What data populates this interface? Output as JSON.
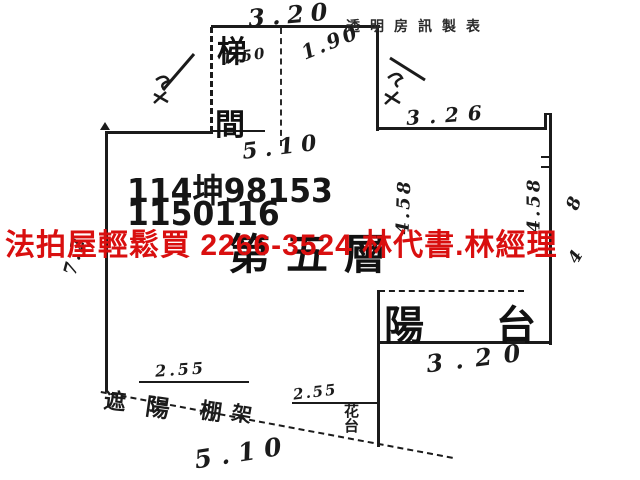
{
  "meta": {
    "publisher_label": "透明房訊製表"
  },
  "case": {
    "line1": "114坤98153",
    "line2": "1150116"
  },
  "watermark": {
    "text": "法拍屋輕鬆買 2266-3524 林代書.林經理",
    "color": "#d90f0f"
  },
  "plan": {
    "floor_label": "第五層",
    "stairwell": {
      "char_top": "梯",
      "char_bottom": "間"
    },
    "balcony_label": "陽台",
    "flower_stand_label": "花台",
    "slant_note_chars": [
      "遮",
      "陽",
      "棚",
      "架"
    ]
  },
  "dimensions": {
    "top": "3.20",
    "stair_left": "1.50",
    "stair_right": "1.90",
    "below_stair": "5.10",
    "upper_right": "3.26",
    "left_wall": "7.2",
    "right_wall_a": "4.58",
    "right_wall_b": "4.58",
    "right_wall_c_top": "8",
    "right_wall_c_bottom": "4",
    "bottom_a": "2.55",
    "bottom_b": "2.55",
    "balcony_width": "3.20",
    "bottom": "5.10"
  }
}
